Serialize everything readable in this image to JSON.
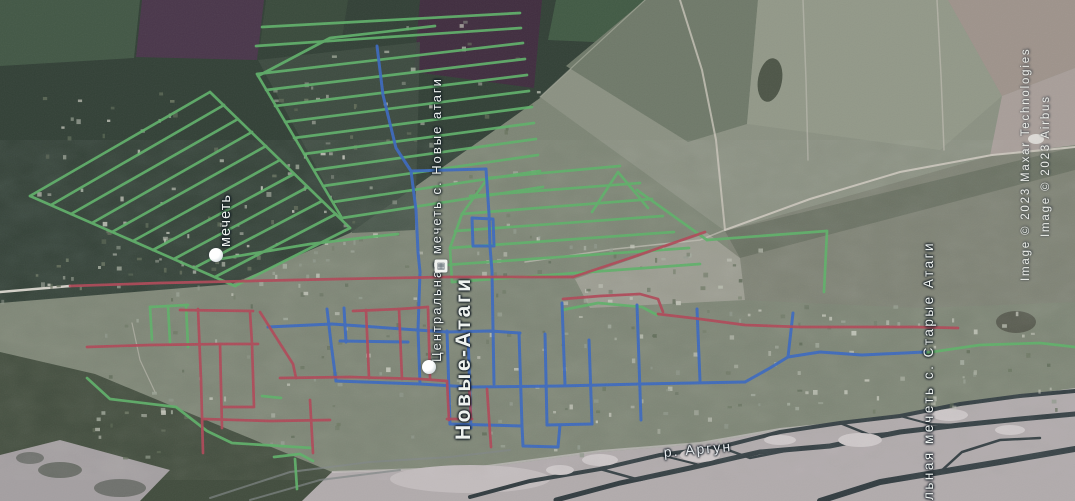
{
  "labels": {
    "mosque_left": {
      "text": "мечеть"
    },
    "mosque_center": {
      "text": "Центральная мечеть с. Новые атаги"
    },
    "town": {
      "text": "Новые-Атаги"
    },
    "mosque_right": {
      "text": "альная мечеть с. Старые Атаги"
    },
    "river": {
      "text": "р. Аргун"
    }
  },
  "attribution": {
    "line1": {
      "text": "Image © 2023 Maxar Technologies"
    },
    "line2": {
      "text": "Image © 2023 Airbus"
    }
  },
  "markers": {
    "placemarks": [
      {
        "name": "mosque-placemark-west",
        "x": 216,
        "y": 255
      },
      {
        "name": "mosque-placemark-center",
        "x": 429,
        "y": 367
      }
    ],
    "building_icon": {
      "name": "building-icon",
      "x": 441,
      "y": 266,
      "glyph": "▦"
    }
  },
  "network": {
    "colors": {
      "green": "#58b263",
      "blue": "#3568c8",
      "red": "#b74455"
    },
    "lines": {
      "green": [
        [
          30,
          196,
          210,
          92
        ],
        [
          51,
          205,
          224,
          105
        ],
        [
          71,
          214,
          238,
          119
        ],
        [
          92,
          223,
          252,
          132
        ],
        [
          112,
          232,
          266,
          146
        ],
        [
          133,
          241,
          280,
          160
        ],
        [
          153,
          250,
          294,
          174
        ],
        [
          174,
          259,
          308,
          187
        ],
        [
          194,
          268,
          322,
          201
        ],
        [
          215,
          277,
          336,
          214
        ],
        [
          235,
          286,
          350,
          228
        ],
        [
          30,
          196,
          135,
          242,
          235,
          286
        ],
        [
          210,
          92,
          280,
          160,
          350,
          228
        ],
        [
          220,
          259,
          310,
          244,
          370,
          237,
          398,
          234
        ],
        [
          262,
          27,
          520,
          13
        ],
        [
          256,
          46,
          521,
          28
        ],
        [
          257,
          74,
          523,
          43
        ],
        [
          266,
          90,
          525,
          59
        ],
        [
          275,
          106,
          527,
          75
        ],
        [
          285,
          122,
          529,
          91
        ],
        [
          294,
          138,
          532,
          107
        ],
        [
          304,
          154,
          534,
          123
        ],
        [
          314,
          170,
          536,
          139
        ],
        [
          323,
          186,
          538,
          155
        ],
        [
          333,
          202,
          540,
          171
        ],
        [
          342,
          218,
          543,
          187
        ],
        [
          257,
          74,
          342,
          218
        ],
        [
          258,
          76,
          330,
          38,
          435,
          26
        ],
        [
          488,
          178,
          620,
          166
        ],
        [
          470,
          196,
          640,
          183
        ],
        [
          462,
          214,
          652,
          199
        ],
        [
          455,
          231,
          663,
          216
        ],
        [
          450,
          248,
          674,
          232
        ],
        [
          445,
          265,
          689,
          248
        ],
        [
          452,
          282,
          700,
          264
        ],
        [
          488,
          178,
          462,
          214,
          450,
          248,
          452,
          282
        ],
        [
          592,
          212,
          618,
          172,
          648,
          208
        ],
        [
          637,
          190,
          707,
          240
        ],
        [
          707,
          240,
          827,
          231
        ],
        [
          827,
          231,
          824,
          292
        ],
        [
          150,
          307,
          152,
          340
        ],
        [
          168,
          306,
          170,
          342
        ],
        [
          186,
          305,
          188,
          347
        ],
        [
          150,
          307,
          188,
          305
        ],
        [
          87,
          378,
          110,
          399,
          176,
          407,
          207,
          431,
          232,
          443,
          312,
          448
        ],
        [
          274,
          457,
          300,
          454,
          313,
          461
        ],
        [
          295,
          459,
          297,
          489
        ],
        [
          262,
          396,
          281,
          398
        ],
        [
          562,
          310,
          598,
          303,
          642,
          307,
          657,
          315
        ],
        [
          925,
          353,
          980,
          345,
          1040,
          343,
          1075,
          347
        ]
      ],
      "blue": [
        [
          377,
          46,
          383,
          95,
          396,
          148,
          411,
          171,
          416,
          210,
          418,
          252,
          420,
          272
        ],
        [
          411,
          171,
          486,
          169
        ],
        [
          486,
          169,
          489,
          214,
          490,
          247,
          492,
          271
        ],
        [
          472,
          218,
          493,
          219,
          494,
          246,
          473,
          246,
          472,
          218
        ],
        [
          420,
          272,
          418,
          330,
          420,
          384
        ],
        [
          268,
          327,
          332,
          324,
          417,
          330
        ],
        [
          340,
          341,
          408,
          342
        ],
        [
          327,
          309,
          331,
          343,
          336,
          381
        ],
        [
          344,
          308,
          346,
          342
        ],
        [
          336,
          381,
          420,
          384
        ],
        [
          420,
          384,
          470,
          387,
          560,
          386,
          640,
          384,
          745,
          382
        ],
        [
          745,
          382,
          770,
          368,
          788,
          357,
          820,
          352,
          862,
          355,
          925,
          352
        ],
        [
          788,
          357,
          793,
          313
        ],
        [
          417,
          330,
          447,
          332,
          490,
          331,
          520,
          333
        ],
        [
          447,
          331,
          450,
          424
        ],
        [
          468,
          334,
          471,
          428
        ],
        [
          492,
          271,
          494,
          384
        ],
        [
          519,
          333,
          522,
          426
        ],
        [
          545,
          334,
          547,
          425
        ],
        [
          562,
          303,
          565,
          385
        ],
        [
          589,
          340,
          592,
          424
        ],
        [
          637,
          305,
          641,
          420
        ],
        [
          697,
          309,
          700,
          381
        ],
        [
          450,
          424,
          522,
          426
        ],
        [
          547,
          425,
          592,
          424
        ],
        [
          522,
          426,
          523,
          446,
          558,
          447,
          560,
          425
        ]
      ],
      "red": [
        [
          70,
          286,
          160,
          283,
          250,
          281,
          340,
          279,
          445,
          277,
          520,
          277,
          573,
          277
        ],
        [
          573,
          277,
          630,
          258,
          705,
          232
        ],
        [
          87,
          347,
          150,
          345,
          222,
          344,
          258,
          344
        ],
        [
          198,
          309,
          201,
          380,
          203,
          453
        ],
        [
          220,
          344,
          222,
          428
        ],
        [
          250,
          312,
          252,
          344
        ],
        [
          252,
          344,
          254,
          407
        ],
        [
          222,
          407,
          253,
          407
        ],
        [
          203,
          419,
          270,
          421,
          330,
          420
        ],
        [
          310,
          400,
          313,
          453
        ],
        [
          260,
          312,
          293,
          364,
          296,
          378
        ],
        [
          280,
          378,
          350,
          377,
          420,
          379,
          447,
          381
        ],
        [
          353,
          311,
          400,
          309,
          428,
          307
        ],
        [
          366,
          310,
          369,
          378
        ],
        [
          399,
          309,
          402,
          379
        ],
        [
          428,
          307,
          430,
          378
        ],
        [
          447,
          381,
          449,
          420
        ],
        [
          469,
          384,
          471,
          419
        ],
        [
          487,
          389,
          491,
          447
        ],
        [
          447,
          419,
          472,
          419
        ],
        [
          563,
          299,
          600,
          296,
          640,
          294,
          658,
          299,
          663,
          312
        ],
        [
          658,
          314,
          700,
          319,
          745,
          325,
          800,
          327,
          870,
          327,
          915,
          327,
          958,
          328
        ],
        [
          180,
          310,
          253,
          311
        ]
      ]
    }
  }
}
